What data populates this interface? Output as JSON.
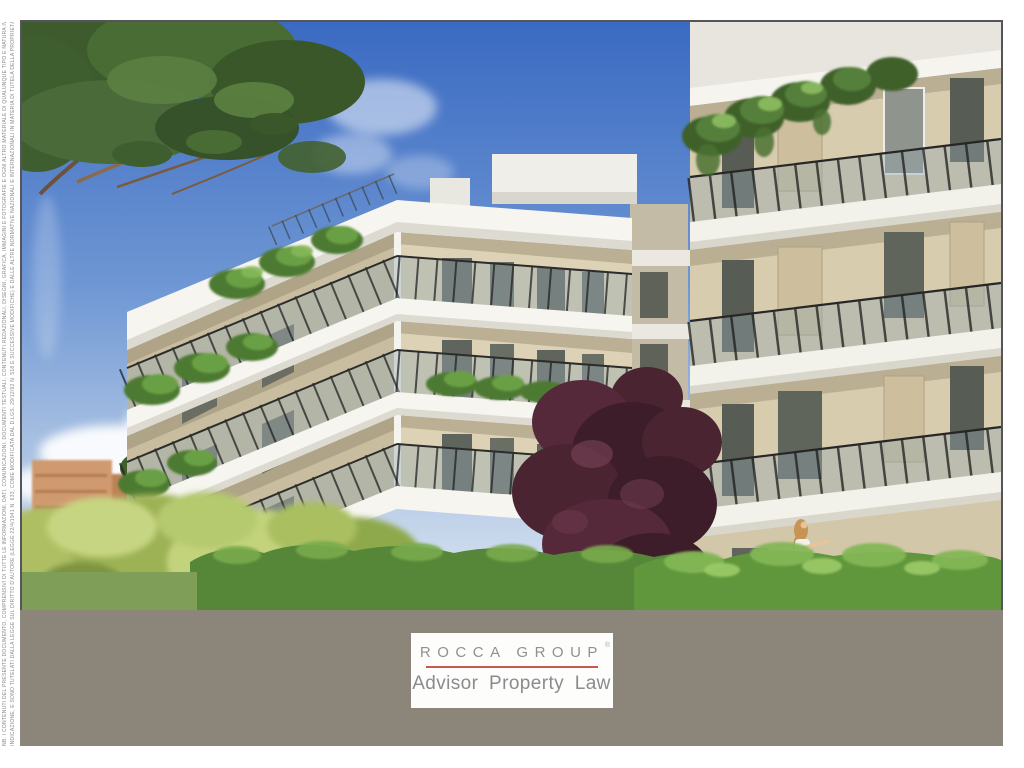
{
  "branding": {
    "logo_name": "ROCCA GROUP",
    "registered_mark": "®",
    "tagline": "Advisor Property Law"
  },
  "disclaimer": {
    "line1": "NB. I CONTENUTI DEL PRESENTE DOCUMENTO, COMPRENSIVI DI TUTTE LE INFORMAZIONI, DATI, COMUNICAZIONI, DOCUMENTI TESTUALI, CONTENUTI REDAZIONALI, DISEGNI, GRAFICA, IMMAGINI E FOTOGRAFIE E OGNI ALTRO MATERIALE DI QUALUNQUE TIPO E NATURA IVI PRESENTI, SONO DI PROPRIETÀ DI ROCCA GROUP SALVO DIVERSA ESPRESSA",
    "line2": "INDICAZIONE, E SONO TUTELATI DALLA LEGGE SUL DIRITTO D'AUTORE (LEGGE 22/4/1941 N. 633, COME MODIFICATA DAL D.LGS. 29/12/92 N. 518 E SUCCESSIVE MODIFICHE) E DALLE ALTRE NORMATIVE NAZIONALI E INTERNAZIONALI IN MATERIA DI TUTELA DELLA PROPRIETÀ INTELLETTUALE E INDUSTRIALE, LORO MODIFICHE E INTEGRAZIONI."
  },
  "colors": {
    "band_gray": "#8b8679",
    "logo_red": "#c65a4c",
    "logo_text": "#909194",
    "tagline_text": "#8a8b8e",
    "frame_border": "#53555a",
    "disclaimer_text": "#8b8b8b",
    "page_bg": "#ffffff",
    "sky_top": "#3a6ac2",
    "sky_bottom": "#dde7f2"
  },
  "scene": {
    "description": "Architectural 3D rendering of two modern white apartment blocks with glass balcony railings and trailing plants, a large Mediterranean stone pine in the upper-left, distant terracotta city buildings, a dark purple plum tree between the blocks, bright green hedges in the foreground and a blonde pedestrian carrying an orange bag.",
    "elements": [
      "sky",
      "clouds",
      "distant-city",
      "stone-pine",
      "left-building",
      "right-building",
      "plum-tree",
      "hedges",
      "pedestrian"
    ]
  }
}
